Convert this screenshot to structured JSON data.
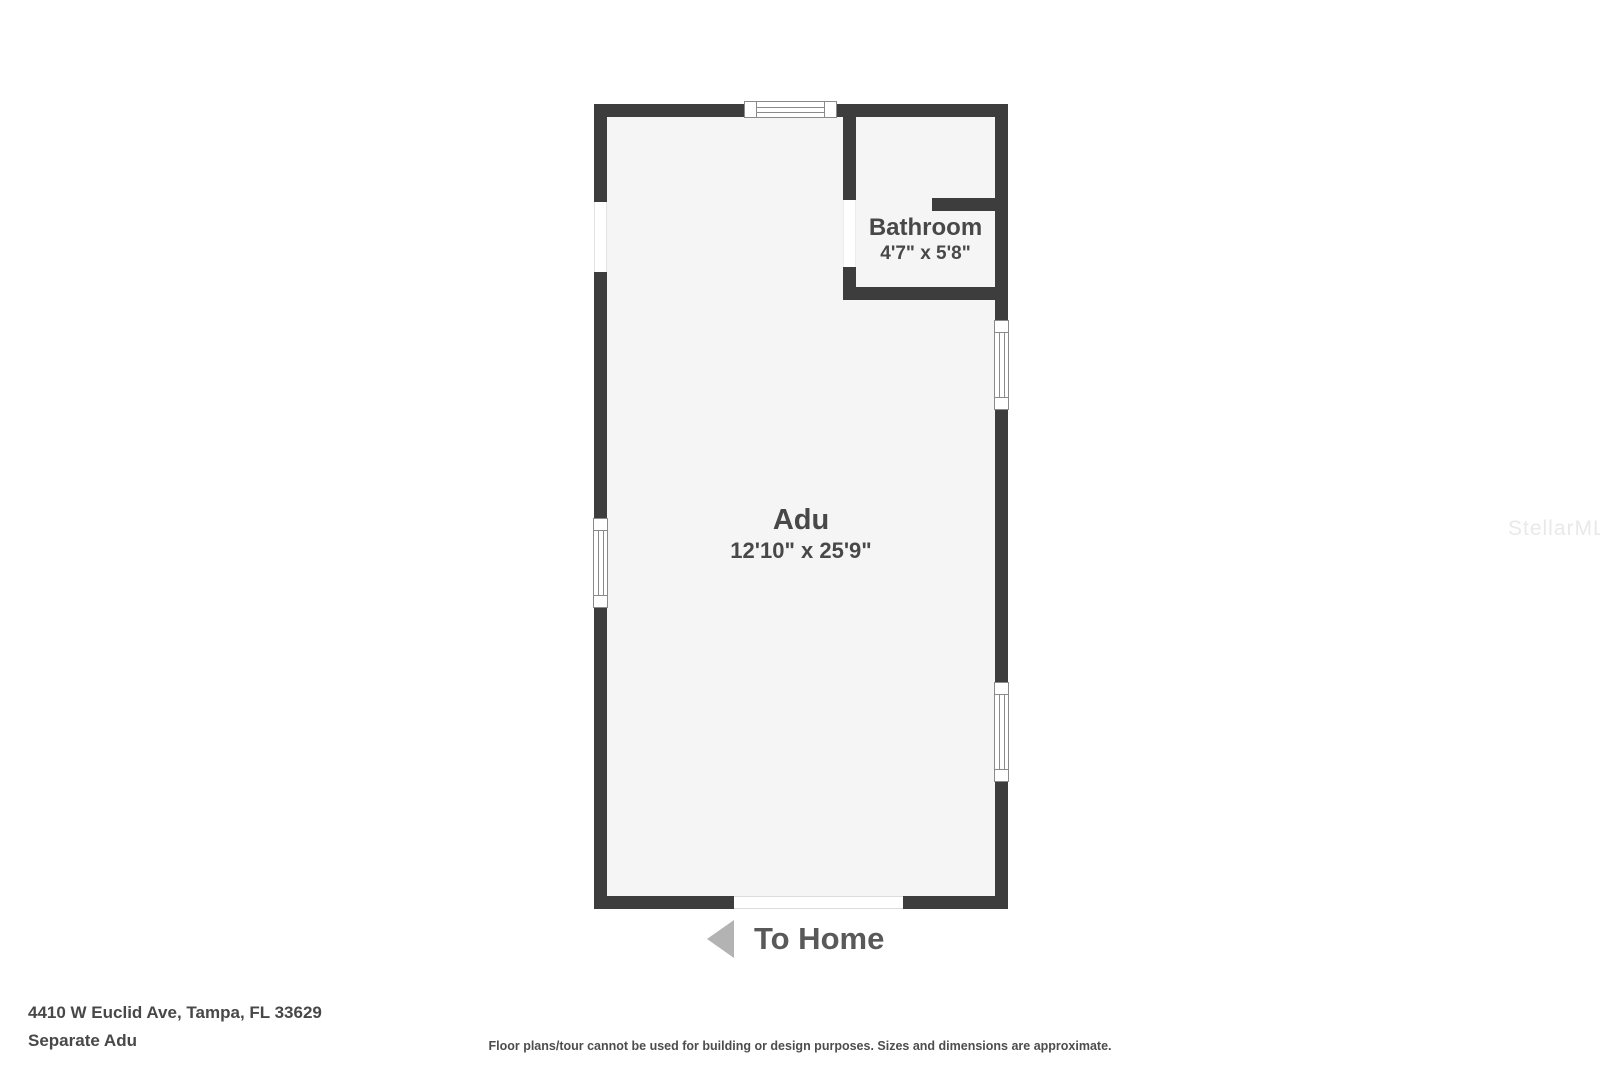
{
  "floor_plan": {
    "rooms": [
      {
        "name": "Adu",
        "dimensions": "12'10\" x 25'9\""
      },
      {
        "name": "Bathroom",
        "dimensions": "4'7\" x 5'8\""
      }
    ],
    "exit_label": "To Home"
  },
  "footer": {
    "address": "4410 W Euclid Ave, Tampa, FL 33629",
    "plan_name": "Separate Adu",
    "disclaimer": "Floor plans/tour cannot be used for building or design purposes. Sizes and dimensions are approximate."
  },
  "watermark": {
    "text": "StellarMLS"
  },
  "colors": {
    "wall": "#3d3d3d",
    "floor": "#f5f5f5",
    "window_line": "#8a8a8a",
    "room_label": "#484848",
    "arrow": "#b3b3b3",
    "exit_text": "#595959",
    "watermark": "#e9e9e9",
    "footer_text": "#484848",
    "disclaimer_text": "#4d4d4d"
  }
}
